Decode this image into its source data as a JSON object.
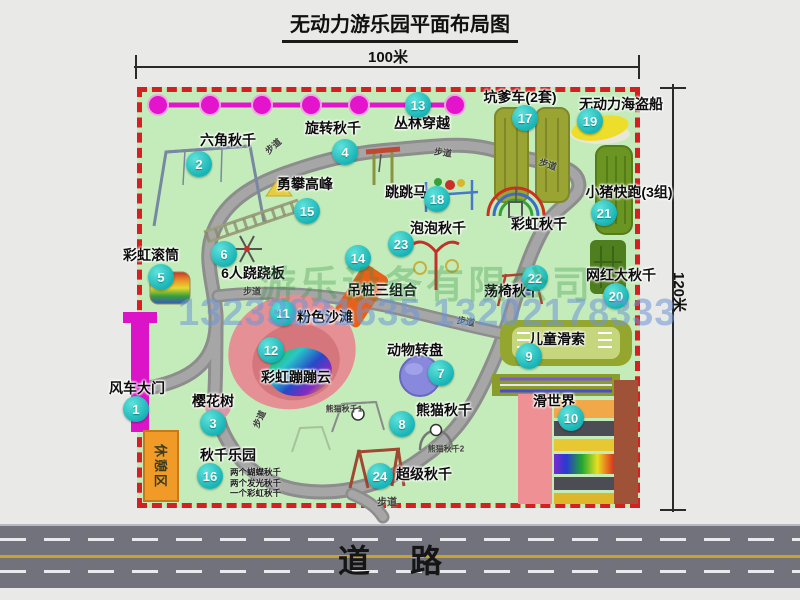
{
  "title": "无动力游乐园平面布局图",
  "dimensions": {
    "width_label": "100米",
    "height_label": "120米"
  },
  "road": {
    "label": "道路"
  },
  "rest_area": {
    "label": "休憩区"
  },
  "watermark": {
    "company": "游乐设备有限公司",
    "phone": "13233831635 13202178333"
  },
  "colors": {
    "map_green": "#c4ecba",
    "border_red": "#d42020",
    "badge_teal": "#17b3b5",
    "zipline_magenta": "#e414cc",
    "gate_magenta": "#dc14c8",
    "road_gray": "#72727c",
    "beach_pink": "#e59095",
    "rest_orange": "#f09a28"
  },
  "map": {
    "facilities": [
      {
        "n": 1,
        "name": "风车大门",
        "lx": 137,
        "ly": 388,
        "bx": 136,
        "by": 409
      },
      {
        "n": 2,
        "name": "六角秋千",
        "lx": 228,
        "ly": 140,
        "bx": 199,
        "by": 164
      },
      {
        "n": 3,
        "name": "樱花树",
        "lx": 213,
        "ly": 401,
        "bx": 213,
        "by": 423
      },
      {
        "n": 4,
        "name": "旋转秋千",
        "lx": 333,
        "ly": 128,
        "bx": 345,
        "by": 152
      },
      {
        "n": 5,
        "name": "彩虹滚筒",
        "lx": 151,
        "ly": 255,
        "bx": 161,
        "by": 277
      },
      {
        "n": 6,
        "name": "6人跷跷板",
        "lx": 253,
        "ly": 273,
        "bx": 224,
        "by": 254
      },
      {
        "n": 7,
        "name": "动物转盘",
        "lx": 415,
        "ly": 350,
        "bx": 441,
        "by": 373
      },
      {
        "n": 8,
        "name": "熊猫秋千",
        "lx": 444,
        "ly": 410,
        "bx": 402,
        "by": 424
      },
      {
        "n": 9,
        "name": "儿童滑索",
        "lx": 557,
        "ly": 339,
        "bx": 529,
        "by": 356
      },
      {
        "n": 10,
        "name": "滑世界",
        "lx": 554,
        "ly": 401,
        "bx": 571,
        "by": 418
      },
      {
        "n": 11,
        "name": "粉色沙滩",
        "lx": 325,
        "ly": 317,
        "bx": 283,
        "by": 313
      },
      {
        "n": 12,
        "name": "彩虹蹦蹦云",
        "lx": 296,
        "ly": 377,
        "bx": 271,
        "by": 350
      },
      {
        "n": 13,
        "name": "丛林穿越",
        "lx": 422,
        "ly": 123,
        "bx": 418,
        "by": 105
      },
      {
        "n": 14,
        "name": "吊桩三组合",
        "lx": 382,
        "ly": 290,
        "bx": 358,
        "by": 258
      },
      {
        "n": 15,
        "name": "勇攀高峰",
        "lx": 305,
        "ly": 184,
        "bx": 307,
        "by": 211
      },
      {
        "n": 16,
        "name": "秋千乐园",
        "lx": 228,
        "ly": 455,
        "bx": 210,
        "by": 476,
        "notes": [
          "两个蝴蝶秋千",
          "两个发光秋千",
          "一个彩虹秋千"
        ],
        "nx": 230,
        "ny": 467
      },
      {
        "n": 17,
        "name": "坑爹车(2套)",
        "lx": 520,
        "ly": 97,
        "bx": 525,
        "by": 118
      },
      {
        "n": 18,
        "name": "跳跳马",
        "lx": 406,
        "ly": 192,
        "bx": 437,
        "by": 199
      },
      {
        "n": 19,
        "name": "无动力海盗船",
        "lx": 621,
        "ly": 104,
        "bx": 590,
        "by": 121
      },
      {
        "n": 20,
        "name": "网红大秋千",
        "lx": 621,
        "ly": 275,
        "bx": 616,
        "by": 296
      },
      {
        "n": 21,
        "name": "小猪快跑(3组)",
        "lx": 629,
        "ly": 192,
        "bx": 604,
        "by": 213
      },
      {
        "n": 22,
        "name": "荡椅秋千",
        "lx": 512,
        "ly": 291,
        "bx": 535,
        "by": 278
      },
      {
        "n": 23,
        "name": "泡泡秋千",
        "lx": 438,
        "ly": 228,
        "bx": 401,
        "by": 244
      },
      {
        "n": 24,
        "name": "超级秋千",
        "lx": 424,
        "ly": 474,
        "bx": 380,
        "by": 476
      },
      {
        "n": null,
        "name": "彩虹秋千",
        "lx": 539,
        "ly": 224
      }
    ],
    "small_labels": [
      {
        "t": "步道",
        "x": 273,
        "y": 146,
        "r": -42,
        "s": 9
      },
      {
        "t": "步道",
        "x": 443,
        "y": 152,
        "r": 8,
        "s": 9
      },
      {
        "t": "步道",
        "x": 548,
        "y": 164,
        "r": 18,
        "s": 9
      },
      {
        "t": "步道",
        "x": 252,
        "y": 291,
        "r": 0,
        "s": 9
      },
      {
        "t": "步道",
        "x": 466,
        "y": 321,
        "r": 10,
        "s": 9
      },
      {
        "t": "步道",
        "x": 259,
        "y": 419,
        "r": -65,
        "s": 9
      },
      {
        "t": "步道",
        "x": 387,
        "y": 501,
        "r": 0,
        "s": 10
      },
      {
        "t": "熊猫秋千1",
        "x": 344,
        "y": 409,
        "r": 0,
        "s": 8
      },
      {
        "t": "熊猫秋千2",
        "x": 446,
        "y": 449,
        "r": 0,
        "s": 8
      }
    ]
  }
}
